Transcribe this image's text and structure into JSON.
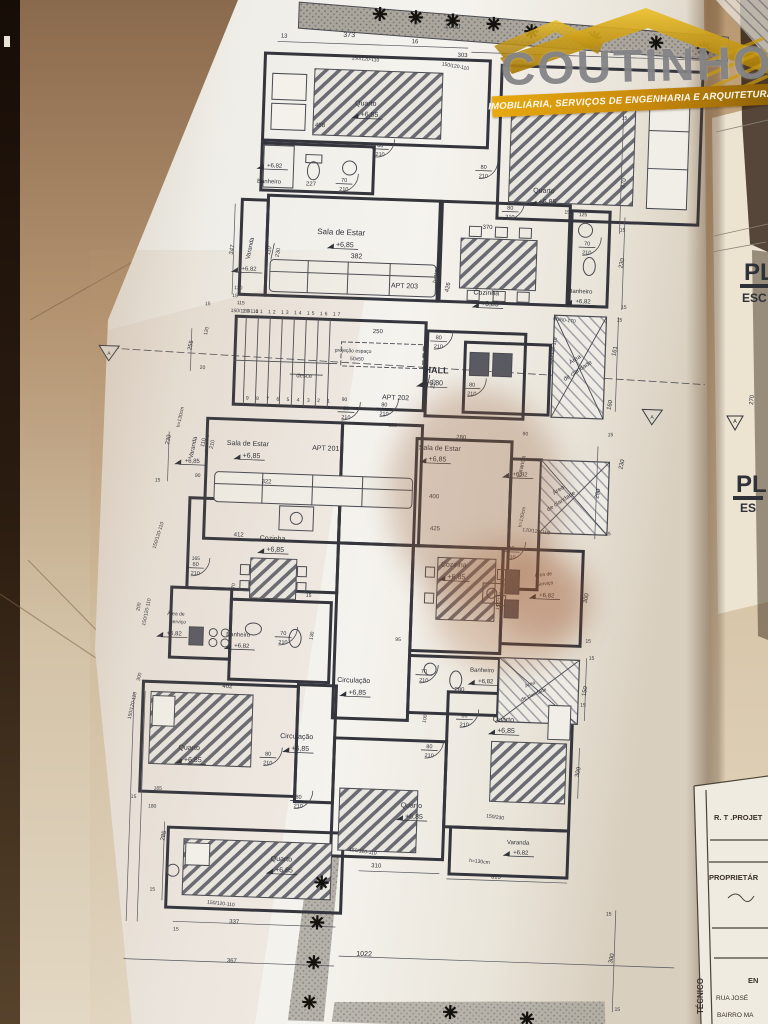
{
  "logo": {
    "brand": "COUTINHO",
    "tagline": "IMOBILIÁRIA, SERVIÇOS DE ENGENHARIA E ARQUITETURA",
    "roof_color": "#d9a612",
    "banner_color": "#c98a0d",
    "brand_color": "#808083"
  },
  "side_sheet": {
    "title1": "PL",
    "subtitle1": "ESC",
    "title2": "PL",
    "subtitle2": "ES",
    "dim": "270",
    "marker": "A"
  },
  "title_block": {
    "row_rt": "R. T .PROJET",
    "row_prop": "PROPRIETÁR",
    "row_en": "EN",
    "row_rua": "RUA JOSÉ",
    "row_bairro": "BAIRRO MA",
    "vertical": "TÉCNICO"
  },
  "plan": {
    "line_color": "#3a3b44",
    "text_color": "#2f3138",
    "paper_color": "#f1efe9",
    "labels": [
      {
        "t": "13",
        "x": 268,
        "y": 42,
        "s": 6
      },
      {
        "t": "373",
        "x": 333,
        "y": 39,
        "s": 7
      },
      {
        "t": "16",
        "x": 399,
        "y": 43,
        "s": 6
      },
      {
        "t": "1060",
        "x": 436,
        "y": 27,
        "s": 7
      },
      {
        "t": "303",
        "x": 447,
        "y": 55,
        "s": 6
      },
      {
        "t": "150/120-110",
        "x": 350,
        "y": 62,
        "s": 5,
        "r": 3
      },
      {
        "t": "150/120-110",
        "x": 440,
        "y": 66,
        "s": 5,
        "r": 8
      },
      {
        "t": "150/230",
        "x": 540,
        "y": 94,
        "s": 5,
        "r": 3
      },
      {
        "t": "15",
        "x": 611,
        "y": 112,
        "s": 5
      },
      {
        "t": "370",
        "x": 614,
        "y": 176,
        "s": 6,
        "r": -80
      },
      {
        "t": "15",
        "x": 613,
        "y": 224,
        "s": 5
      },
      {
        "t": "Quarto",
        "x": 352,
        "y": 107,
        "s": 7
      },
      {
        "t": "+6,85",
        "x": 356,
        "y": 118,
        "s": 7
      },
      {
        "t": "458",
        "x": 307,
        "y": 130,
        "s": 6
      },
      {
        "t": "Quarto",
        "x": 533,
        "y": 188,
        "s": 7
      },
      {
        "t": "+6,85",
        "x": 537,
        "y": 199,
        "s": 7
      },
      {
        "t": "+6,82",
        "x": 263,
        "y": 172,
        "s": 6
      },
      {
        "t": "Banheiro",
        "x": 258,
        "y": 188,
        "s": 6
      },
      {
        "t": "227",
        "x": 300,
        "y": 189,
        "s": 6
      },
      {
        "t": "Varanda",
        "x": 243,
        "y": 254,
        "s": 6,
        "r": -80
      },
      {
        "t": "+6,82",
        "x": 241,
        "y": 276,
        "s": 6
      },
      {
        "t": "347",
        "x": 225,
        "y": 256,
        "s": 6,
        "r": -80
      },
      {
        "t": "Sala de Estar",
        "x": 332,
        "y": 237,
        "s": 8
      },
      {
        "t": "+6,85",
        "x": 336,
        "y": 249,
        "s": 7
      },
      {
        "t": "382",
        "x": 348,
        "y": 260,
        "s": 7
      },
      {
        "t": "APT 203",
        "x": 397,
        "y": 288,
        "s": 7
      },
      {
        "t": "370",
        "x": 478,
        "y": 226,
        "s": 6
      },
      {
        "t": "h=110cm",
        "x": 430,
        "y": 272,
        "s": 5,
        "r": -80
      },
      {
        "t": "426",
        "x": 442,
        "y": 286,
        "s": 6,
        "r": -80
      },
      {
        "t": "Cozinha",
        "x": 479,
        "y": 292,
        "s": 7
      },
      {
        "t": "+6,85",
        "x": 483,
        "y": 303,
        "s": 7
      },
      {
        "t": "15",
        "x": 557,
        "y": 208,
        "s": 5
      },
      {
        "t": "125",
        "x": 573,
        "y": 210,
        "s": 5
      },
      {
        "t": "Banheiro",
        "x": 573,
        "y": 287,
        "s": 6
      },
      {
        "t": "+6,82",
        "x": 576,
        "y": 297,
        "s": 6
      },
      {
        "t": "230",
        "x": 615,
        "y": 256,
        "s": 6,
        "r": -80
      },
      {
        "t": "15",
        "x": 617,
        "y": 301,
        "s": 5
      },
      {
        "t": "60/60-170",
        "x": 558,
        "y": 316,
        "s": 5,
        "r": 5
      },
      {
        "t": "Área",
        "x": 571,
        "y": 355,
        "s": 6,
        "r": -35
      },
      {
        "t": "de claridade",
        "x": 574,
        "y": 366,
        "s": 6,
        "r": -35
      },
      {
        "t": "150/120-110",
        "x": 549,
        "y": 346,
        "s": 5,
        "r": -80
      },
      {
        "t": "161",
        "x": 611,
        "y": 344,
        "s": 6,
        "r": -80
      },
      {
        "t": "15",
        "x": 613,
        "y": 314,
        "s": 5
      },
      {
        "t": "160",
        "x": 608,
        "y": 398,
        "s": 6,
        "r": -80
      },
      {
        "t": "10 11 12 13 14 15 16 17",
        "x": 286,
        "y": 318,
        "s": 5,
        "ls": 2
      },
      {
        "t": "9 8 7 6 5 4 3 2 1",
        "x": 286,
        "y": 405,
        "s": 5,
        "ls": 3
      },
      {
        "t": "desce",
        "x": 300,
        "y": 381,
        "s": 6
      },
      {
        "t": "projeção espaço",
        "x": 348,
        "y": 354,
        "s": 5
      },
      {
        "t": "50x50",
        "x": 352,
        "y": 362,
        "s": 5
      },
      {
        "t": "250",
        "x": 372,
        "y": 334,
        "s": 6
      },
      {
        "t": "HALL",
        "x": 432,
        "y": 372,
        "s": 9,
        "b": 1
      },
      {
        "t": "+6,80",
        "x": 430,
        "y": 384,
        "s": 7
      },
      {
        "t": "APT 202",
        "x": 392,
        "y": 400,
        "s": 7
      },
      {
        "t": "90",
        "x": 341,
        "y": 403,
        "s": 5
      },
      {
        "t": "120",
        "x": 390,
        "y": 427,
        "s": 5
      },
      {
        "t": "130",
        "x": 231,
        "y": 295,
        "s": 5
      },
      {
        "t": "15",
        "x": 228,
        "y": 303,
        "s": 5
      },
      {
        "t": "115",
        "x": 234,
        "y": 310,
        "s": 5
      },
      {
        "t": "150/120-110",
        "x": 238,
        "y": 318,
        "s": 5
      },
      {
        "t": "15",
        "x": 201,
        "y": 312,
        "s": 5
      },
      {
        "t": "120",
        "x": 202,
        "y": 338,
        "s": 5,
        "r": -80
      },
      {
        "t": "255",
        "x": 187,
        "y": 353,
        "s": 6,
        "r": -80
      },
      {
        "t": "20",
        "x": 198,
        "y": 376,
        "s": 5
      },
      {
        "t": "A",
        "x": 104,
        "y": 365,
        "s": 5
      },
      {
        "t": "A",
        "x": 649,
        "y": 410,
        "s": 5
      },
      {
        "t": "Sala de Estar",
        "x": 246,
        "y": 451,
        "s": 7
      },
      {
        "t": "+6,85",
        "x": 250,
        "y": 463,
        "s": 7
      },
      {
        "t": "APT 201",
        "x": 324,
        "y": 453,
        "s": 7
      },
      {
        "t": "322",
        "x": 266,
        "y": 488,
        "s": 6
      },
      {
        "t": "Varanda",
        "x": 193,
        "y": 455,
        "s": 6,
        "r": -80
      },
      {
        "t": "+6,85",
        "x": 191,
        "y": 470,
        "s": 6
      },
      {
        "t": "h=130cm",
        "x": 179,
        "y": 425,
        "s": 5,
        "r": -80
      },
      {
        "t": "230",
        "x": 168,
        "y": 448,
        "s": 6,
        "r": -80
      },
      {
        "t": "15",
        "x": 157,
        "y": 490,
        "s": 5
      },
      {
        "t": "90",
        "x": 197,
        "y": 484,
        "s": 5
      },
      {
        "t": "Sala de Estar",
        "x": 438,
        "y": 449,
        "s": 7
      },
      {
        "t": "+6,85",
        "x": 436,
        "y": 460,
        "s": 7
      },
      {
        "t": "280",
        "x": 459,
        "y": 437,
        "s": 6
      },
      {
        "t": "90",
        "x": 523,
        "y": 431,
        "s": 5
      },
      {
        "t": "400",
        "x": 434,
        "y": 497,
        "s": 6
      },
      {
        "t": "425",
        "x": 436,
        "y": 529,
        "s": 6
      },
      {
        "t": "Varanda",
        "x": 522,
        "y": 463,
        "s": 6,
        "r": -80
      },
      {
        "t": "+6,82",
        "x": 519,
        "y": 472,
        "s": 6
      },
      {
        "t": "h=130cm",
        "x": 524,
        "y": 513,
        "s": 5,
        "r": -80
      },
      {
        "t": "120/120-110",
        "x": 537,
        "y": 528,
        "s": 5,
        "r": 5
      },
      {
        "t": "Área",
        "x": 559,
        "y": 486,
        "s": 6,
        "r": -35
      },
      {
        "t": "de claridade",
        "x": 562,
        "y": 497,
        "s": 6,
        "r": -35
      },
      {
        "t": "290",
        "x": 599,
        "y": 487,
        "s": 6,
        "r": -80
      },
      {
        "t": "15",
        "x": 608,
        "y": 429,
        "s": 5
      },
      {
        "t": "230",
        "x": 622,
        "y": 457,
        "s": 6,
        "r": -80
      },
      {
        "t": "15",
        "x": 609,
        "y": 528,
        "s": 5
      },
      {
        "t": "412",
        "x": 240,
        "y": 542,
        "s": 6
      },
      {
        "t": "Cozinha",
        "x": 274,
        "y": 545,
        "s": 7
      },
      {
        "t": "+6,85",
        "x": 277,
        "y": 556,
        "s": 7
      },
      {
        "t": "165",
        "x": 198,
        "y": 567,
        "s": 5
      },
      {
        "t": "70",
        "x": 238,
        "y": 592,
        "s": 5,
        "r": -80
      },
      {
        "t": "Área de",
        "x": 180,
        "y": 623,
        "s": 5
      },
      {
        "t": "Serviço",
        "x": 182,
        "y": 631,
        "s": 5
      },
      {
        "t": "+6,82",
        "x": 179,
        "y": 643,
        "s": 6
      },
      {
        "t": "200",
        "x": 144,
        "y": 616,
        "s": 5,
        "r": -80
      },
      {
        "t": "150/120-110",
        "x": 161,
        "y": 544,
        "s": 5,
        "r": -75
      },
      {
        "t": "150/120-110",
        "x": 152,
        "y": 621,
        "s": 5,
        "r": -80
      },
      {
        "t": "Banheiro",
        "x": 243,
        "y": 642,
        "s": 6
      },
      {
        "t": "+6,82",
        "x": 247,
        "y": 653,
        "s": 6
      },
      {
        "t": "130",
        "x": 318,
        "y": 639,
        "s": 5,
        "r": -80
      },
      {
        "t": "15",
        "x": 312,
        "y": 600,
        "s": 5
      },
      {
        "t": "Cozinha",
        "x": 456,
        "y": 565,
        "s": 7
      },
      {
        "t": "+6,85",
        "x": 459,
        "y": 577,
        "s": 7
      },
      {
        "t": "Área de",
        "x": 546,
        "y": 571,
        "s": 5,
        "r": -8
      },
      {
        "t": "Serviço",
        "x": 548,
        "y": 580,
        "s": 5,
        "r": -8
      },
      {
        "t": "+6,82",
        "x": 550,
        "y": 592,
        "s": 6
      },
      {
        "t": "150/120-110",
        "x": 505,
        "y": 593,
        "s": 5,
        "r": -80
      },
      {
        "t": "300",
        "x": 591,
        "y": 592,
        "s": 6,
        "r": -80
      },
      {
        "t": "15",
        "x": 593,
        "y": 636,
        "s": 5
      },
      {
        "t": "95",
        "x": 403,
        "y": 641,
        "s": 5
      },
      {
        "t": "Banheiro",
        "x": 488,
        "y": 669,
        "s": 6
      },
      {
        "t": "+6,82",
        "x": 492,
        "y": 680,
        "s": 6
      },
      {
        "t": "280",
        "x": 466,
        "y": 689,
        "s": 6
      },
      {
        "t": "Área",
        "x": 537,
        "y": 681,
        "s": 5,
        "r": -25
      },
      {
        "t": "de claridade",
        "x": 541,
        "y": 691,
        "s": 5,
        "r": -25
      },
      {
        "t": "150",
        "x": 593,
        "y": 685,
        "s": 6,
        "r": -80
      },
      {
        "t": "15",
        "x": 597,
        "y": 653,
        "s": 5
      },
      {
        "t": "Circulação",
        "x": 360,
        "y": 684,
        "s": 7
      },
      {
        "t": "+6,85",
        "x": 364,
        "y": 696,
        "s": 7
      },
      {
        "t": "100",
        "x": 434,
        "y": 718,
        "s": 5,
        "r": -80
      },
      {
        "t": "Circulação",
        "x": 305,
        "y": 742,
        "s": 7
      },
      {
        "t": "+6,85",
        "x": 309,
        "y": 754,
        "s": 7
      },
      {
        "t": "402",
        "x": 234,
        "y": 694,
        "s": 6
      },
      {
        "t": "Quarto",
        "x": 198,
        "y": 757,
        "s": 7
      },
      {
        "t": "+6,85",
        "x": 202,
        "y": 769,
        "s": 7
      },
      {
        "t": "165",
        "x": 168,
        "y": 798,
        "s": 5
      },
      {
        "t": "15",
        "x": 144,
        "y": 807,
        "s": 5
      },
      {
        "t": "180",
        "x": 163,
        "y": 816,
        "s": 5
      },
      {
        "t": "285",
        "x": 177,
        "y": 844,
        "s": 6,
        "r": -80
      },
      {
        "t": "150/120-110",
        "x": 141,
        "y": 715,
        "s": 5,
        "r": -80
      },
      {
        "t": "300",
        "x": 147,
        "y": 686,
        "s": 5,
        "r": -80
      },
      {
        "t": "15",
        "x": 166,
        "y": 899,
        "s": 5
      },
      {
        "t": "Quarto",
        "x": 294,
        "y": 865,
        "s": 7
      },
      {
        "t": "+6,85",
        "x": 297,
        "y": 876,
        "s": 7
      },
      {
        "t": "150/120-110",
        "x": 235,
        "y": 911,
        "s": 5,
        "r": 4
      },
      {
        "t": "337",
        "x": 249,
        "y": 929,
        "s": 6
      },
      {
        "t": "15",
        "x": 191,
        "y": 938,
        "s": 5
      },
      {
        "t": "367",
        "x": 248,
        "y": 968,
        "s": 6
      },
      {
        "t": "Quarto",
        "x": 422,
        "y": 807,
        "s": 7
      },
      {
        "t": "+6,85",
        "x": 425,
        "y": 818,
        "s": 7
      },
      {
        "t": "150/120-110",
        "x": 375,
        "y": 854,
        "s": 5,
        "r": 6
      },
      {
        "t": "310",
        "x": 389,
        "y": 868,
        "s": 6
      },
      {
        "t": "Quarto",
        "x": 511,
        "y": 718,
        "s": 7
      },
      {
        "t": "+6,85",
        "x": 514,
        "y": 729,
        "s": 7
      },
      {
        "t": "150/230",
        "x": 506,
        "y": 815,
        "s": 5,
        "r": 6
      },
      {
        "t": "300",
        "x": 589,
        "y": 766,
        "s": 6,
        "r": -80
      },
      {
        "t": "15",
        "x": 590,
        "y": 700,
        "s": 5
      },
      {
        "t": "Varanda",
        "x": 530,
        "y": 840,
        "s": 6
      },
      {
        "t": "+6,82",
        "x": 533,
        "y": 850,
        "s": 6
      },
      {
        "t": "h=130cm",
        "x": 492,
        "y": 860,
        "s": 5,
        "r": 4
      },
      {
        "t": "315",
        "x": 509,
        "y": 875,
        "s": 6
      },
      {
        "t": "1022",
        "x": 380,
        "y": 957,
        "s": 7
      },
      {
        "t": "300",
        "x": 629,
        "y": 951,
        "s": 6,
        "r": -80
      },
      {
        "t": "15",
        "x": 623,
        "y": 908,
        "s": 5
      },
      {
        "t": "15",
        "x": 635,
        "y": 1003,
        "s": 5
      }
    ],
    "door_labels": [
      {
        "a": "70",
        "b": "210",
        "x": 333,
        "y": 186
      },
      {
        "a": "80",
        "b": "210",
        "x": 368,
        "y": 150
      },
      {
        "a": "80",
        "b": "210",
        "x": 472,
        "y": 168
      },
      {
        "a": "80",
        "b": "210",
        "x": 500,
        "y": 208
      },
      {
        "a": "70",
        "b": "210",
        "x": 578,
        "y": 241
      },
      {
        "a": "80",
        "b": "210",
        "x": 433,
        "y": 340
      },
      {
        "a": "80",
        "b": "210",
        "x": 343,
        "y": 414
      },
      {
        "a": "80",
        "b": "210",
        "x": 381,
        "y": 409
      },
      {
        "a": "60",
        "b": "210",
        "x": 424,
        "y": 382,
        "r": -80
      },
      {
        "a": "80",
        "b": "210",
        "x": 468,
        "y": 386
      },
      {
        "a": "110",
        "b": "210",
        "x": 205,
        "y": 450,
        "r": -80
      },
      {
        "a": "110",
        "b": "230",
        "x": 264,
        "y": 256,
        "r": -80
      },
      {
        "a": "60",
        "b": "210",
        "x": 198,
        "y": 575
      },
      {
        "a": "70",
        "b": "210",
        "x": 288,
        "y": 641
      },
      {
        "a": "80",
        "b": "210",
        "x": 513,
        "y": 548
      },
      {
        "a": "70",
        "b": "210",
        "x": 430,
        "y": 674
      },
      {
        "a": "80",
        "b": "210",
        "x": 277,
        "y": 762
      },
      {
        "a": "80",
        "b": "210",
        "x": 309,
        "y": 804
      },
      {
        "a": "80",
        "b": "210",
        "x": 472,
        "y": 717
      },
      {
        "a": "80",
        "b": "210",
        "x": 438,
        "y": 749
      }
    ],
    "plant_symbols": [
      [
        363,
        15
      ],
      [
        399,
        17
      ],
      [
        436,
        19
      ],
      [
        477,
        21
      ],
      [
        515,
        27
      ],
      [
        578,
        31
      ],
      [
        640,
        34
      ],
      [
        688,
        38
      ],
      [
        335,
        885
      ],
      [
        332,
        925
      ],
      [
        330,
        965
      ],
      [
        327,
        1005
      ],
      [
        468,
        1010
      ],
      [
        545,
        1014
      ]
    ]
  }
}
